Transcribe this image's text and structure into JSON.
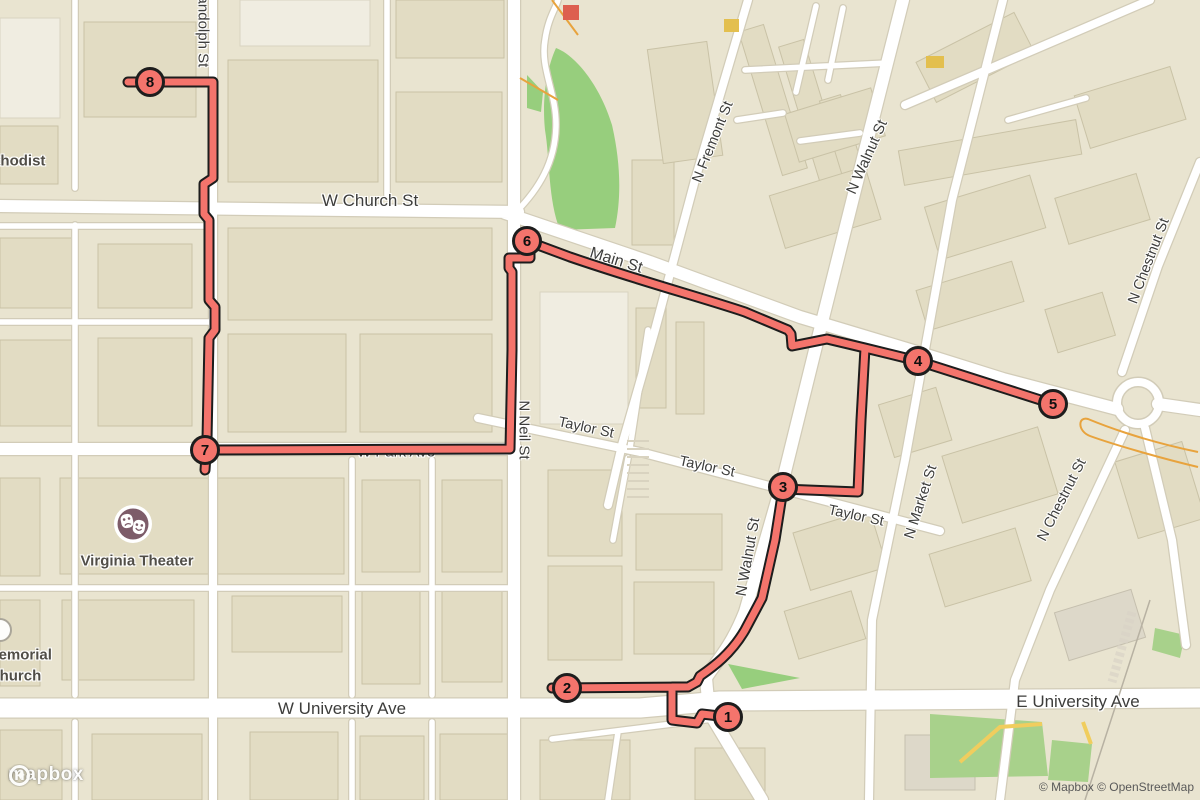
{
  "map": {
    "street_labels": [
      {
        "id": "randolph-st",
        "text": "Randolph St"
      },
      {
        "id": "w-church-st",
        "text": "W Church St"
      },
      {
        "id": "main-st",
        "text": "Main St"
      },
      {
        "id": "n-fremont-st",
        "text": "N Fremont St"
      },
      {
        "id": "n-walnut-st-north",
        "text": "N Walnut St"
      },
      {
        "id": "n-walnut-st-mid",
        "text": "N Walnut St"
      },
      {
        "id": "n-market-st",
        "text": "N Market St"
      },
      {
        "id": "n-chestnut-st-north",
        "text": "N Chestnut St"
      },
      {
        "id": "n-chestnut-st-south",
        "text": "N Chestnut St"
      },
      {
        "id": "n-neil-st",
        "text": "N Neil St"
      },
      {
        "id": "taylor-st-west",
        "text": "Taylor St"
      },
      {
        "id": "taylor-st-mid",
        "text": "Taylor St"
      },
      {
        "id": "taylor-st-east",
        "text": "Taylor St"
      },
      {
        "id": "w-park-ave",
        "text": "W Park Ave"
      },
      {
        "id": "w-university-ave",
        "text": "W University Ave"
      },
      {
        "id": "e-university-ave",
        "text": "E University Ave"
      }
    ],
    "poi_labels": {
      "methodist": {
        "text": "Methodist"
      },
      "virginia_theater": {
        "text": "Virginia Theater"
      },
      "memorial_church": {
        "line1": "Memorial",
        "line2": "Church"
      }
    },
    "markers": [
      {
        "n": "1"
      },
      {
        "n": "2"
      },
      {
        "n": "3"
      },
      {
        "n": "4"
      },
      {
        "n": "5"
      },
      {
        "n": "6"
      },
      {
        "n": "7"
      },
      {
        "n": "8"
      }
    ],
    "colors": {
      "route": "#f4746c",
      "route_casing": "#1d1d1d",
      "marker_fill": "#f4746c",
      "land": "#e9e4d0",
      "building": "#e2dcc3",
      "street": "#ffffff",
      "park_green": "#97ce7d",
      "label_text": "#3d3d3b",
      "theater_icon": "#7d5c69"
    }
  },
  "attribution": {
    "logo_text": "mapbox",
    "copyright": "© Mapbox © OpenStreetMap"
  }
}
